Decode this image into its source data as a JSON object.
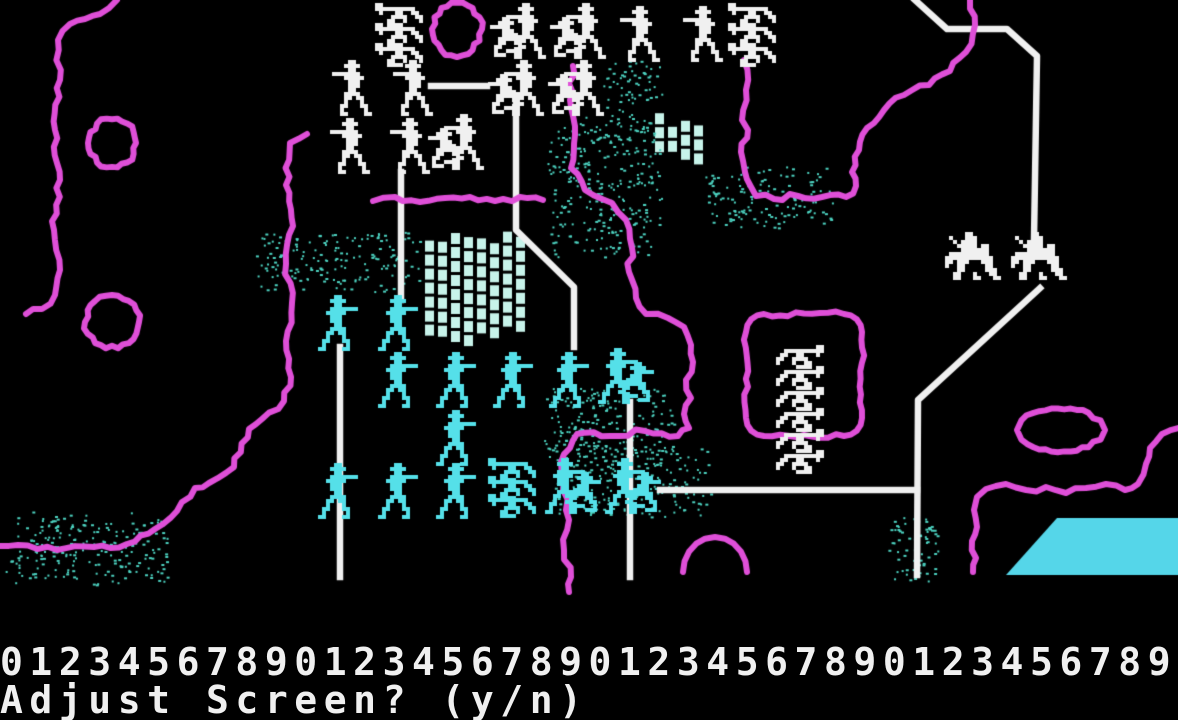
{
  "screen": {
    "width": 1178,
    "height": 720
  },
  "colors": {
    "background": "#000000",
    "white": "#f0f0f0",
    "cyan_unit": "#55e0e9",
    "forest_teal": "#4cd2c0",
    "brick": "#c7f3ea",
    "lake": "#55d6e9",
    "magenta": "#df4fd8",
    "road": "#f0f0f0",
    "text": "#f0f0f0"
  },
  "status": {
    "ruler": "0123456789012345678901234567890123456789",
    "prompt": "Adjust Screen? (y/n)"
  },
  "map": {
    "units": [
      {
        "kind": "cannon-unit",
        "color": "white",
        "mirror": false,
        "positions": [
          [
            375,
            3
          ],
          [
            375,
            23
          ],
          [
            375,
            43
          ],
          [
            728,
            3
          ],
          [
            728,
            23
          ],
          [
            728,
            43
          ]
        ]
      },
      {
        "kind": "infantry-pair-unit",
        "color": "white",
        "mirror": false,
        "positions": [
          [
            490,
            3
          ],
          [
            550,
            3
          ],
          [
            488,
            60
          ],
          [
            548,
            60
          ],
          [
            428,
            114
          ]
        ]
      },
      {
        "kind": "infantry-unit",
        "color": "white",
        "mirror": false,
        "positions": [
          [
            620,
            6
          ],
          [
            683,
            6
          ],
          [
            332,
            60
          ],
          [
            393,
            60
          ],
          [
            330,
            118
          ],
          [
            390,
            118
          ]
        ]
      },
      {
        "kind": "cannon-unit",
        "color": "white",
        "mirror": true,
        "positions": [
          [
            772,
            345
          ],
          [
            772,
            366
          ],
          [
            772,
            387
          ],
          [
            772,
            408
          ],
          [
            772,
            429
          ],
          [
            772,
            450
          ]
        ]
      },
      {
        "kind": "cavalry-unit",
        "color": "white",
        "mirror": false,
        "positions": [
          [
            941,
            232
          ],
          [
            1007,
            232
          ]
        ]
      },
      {
        "kind": "infantry-unit",
        "color": "cyan",
        "mirror": true,
        "positions": [
          [
            318,
            295
          ],
          [
            378,
            295
          ],
          [
            378,
            352
          ],
          [
            436,
            352
          ],
          [
            493,
            352
          ],
          [
            549,
            352
          ],
          [
            436,
            410
          ],
          [
            318,
            463
          ],
          [
            378,
            463
          ],
          [
            436,
            463
          ]
        ]
      },
      {
        "kind": "infantry-pair-unit",
        "color": "cyan",
        "mirror": true,
        "positions": [
          [
            598,
            348
          ],
          [
            545,
            458
          ],
          [
            605,
            458
          ]
        ]
      },
      {
        "kind": "cannon-unit",
        "color": "cyan",
        "mirror": false,
        "positions": [
          [
            488,
            458
          ],
          [
            488,
            476
          ],
          [
            488,
            494
          ]
        ]
      }
    ],
    "rivers": [
      {
        "name": "west-creek",
        "points": [
          [
            117,
            0
          ],
          [
            100,
            14
          ],
          [
            70,
            24
          ],
          [
            58,
            40
          ],
          [
            60,
            80
          ],
          [
            55,
            130
          ],
          [
            60,
            180
          ],
          [
            54,
            230
          ],
          [
            60,
            270
          ],
          [
            55,
            295
          ],
          [
            42,
            309
          ],
          [
            26,
            314
          ]
        ]
      },
      {
        "name": "southwest-river",
        "points": [
          [
            307,
            134
          ],
          [
            290,
            143
          ],
          [
            286,
            185
          ],
          [
            293,
            226
          ],
          [
            286,
            264
          ],
          [
            292,
            303
          ],
          [
            286,
            341
          ],
          [
            291,
            377
          ],
          [
            284,
            401
          ],
          [
            262,
            419
          ],
          [
            249,
            429
          ],
          [
            234,
            467
          ],
          [
            209,
            483
          ],
          [
            195,
            488
          ],
          [
            177,
            511
          ],
          [
            155,
            529
          ],
          [
            127,
            544
          ],
          [
            94,
            547
          ],
          [
            57,
            550
          ],
          [
            18,
            545
          ],
          [
            0,
            546
          ]
        ]
      },
      {
        "name": "central-river",
        "points": [
          [
            573,
            66
          ],
          [
            570,
            100
          ],
          [
            575,
            135
          ],
          [
            571,
            168
          ],
          [
            585,
            190
          ],
          [
            612,
            203
          ],
          [
            626,
            220
          ],
          [
            632,
            248
          ],
          [
            629,
            272
          ],
          [
            636,
            298
          ],
          [
            646,
            314
          ],
          [
            668,
            318
          ],
          [
            684,
            327
          ],
          [
            691,
            345
          ],
          [
            693,
            362
          ],
          [
            686,
            380
          ],
          [
            691,
            398
          ],
          [
            684,
            414
          ],
          [
            689,
            428
          ],
          [
            678,
            436
          ],
          [
            645,
            431
          ],
          [
            610,
            436
          ],
          [
            577,
            434
          ],
          [
            570,
            448
          ],
          [
            561,
            462
          ],
          [
            563,
            490
          ],
          [
            569,
            520
          ],
          [
            564,
            550
          ],
          [
            571,
            577
          ],
          [
            569,
            592
          ]
        ]
      },
      {
        "name": "north-river",
        "points": [
          [
            970,
            0
          ],
          [
            975,
            25
          ],
          [
            966,
            52
          ],
          [
            950,
            71
          ],
          [
            929,
            85
          ],
          [
            904,
            95
          ],
          [
            884,
            110
          ],
          [
            867,
            128
          ],
          [
            859,
            150
          ],
          [
            852,
            172
          ],
          [
            856,
            186
          ],
          [
            846,
            197
          ],
          [
            822,
            197
          ],
          [
            798,
            196
          ],
          [
            774,
            199
          ],
          [
            756,
            196
          ],
          [
            750,
            185
          ],
          [
            745,
            172
          ],
          [
            741,
            152
          ],
          [
            748,
            130
          ],
          [
            742,
            120
          ],
          [
            746,
            90
          ],
          [
            744,
            60
          ]
        ]
      },
      {
        "name": "southeast-river",
        "points": [
          [
            1178,
            428
          ],
          [
            1162,
            434
          ],
          [
            1150,
            448
          ],
          [
            1146,
            464
          ],
          [
            1138,
            484
          ],
          [
            1125,
            490
          ],
          [
            1106,
            484
          ],
          [
            1086,
            488
          ],
          [
            1066,
            493
          ],
          [
            1046,
            487
          ],
          [
            1026,
            490
          ],
          [
            1006,
            484
          ],
          [
            986,
            489
          ],
          [
            977,
            497
          ],
          [
            974,
            510
          ],
          [
            977,
            527
          ],
          [
            972,
            541
          ],
          [
            976,
            558
          ],
          [
            973,
            572
          ]
        ]
      },
      {
        "name": "small-branch",
        "points": [
          [
            373,
            201
          ],
          [
            395,
            197
          ],
          [
            420,
            202
          ],
          [
            445,
            198
          ],
          [
            470,
            197
          ],
          [
            495,
            201
          ],
          [
            520,
            197
          ],
          [
            543,
            200
          ]
        ]
      }
    ],
    "roads": [
      {
        "name": "north-road",
        "points": [
          [
            915,
            0
          ],
          [
            947,
            29
          ],
          [
            1007,
            29
          ],
          [
            1037,
            56
          ],
          [
            1034,
            240
          ]
        ]
      },
      {
        "name": "east-road",
        "points": [
          [
            1040,
            288
          ],
          [
            918,
            400
          ],
          [
            917,
            575
          ]
        ]
      },
      {
        "name": "south-road",
        "points": [
          [
            660,
            490
          ],
          [
            917,
            490
          ]
        ]
      },
      {
        "name": "center-road",
        "points": [
          [
            630,
            402
          ],
          [
            630,
            577
          ]
        ]
      },
      {
        "name": "west-road",
        "points": [
          [
            340,
            347
          ],
          [
            340,
            577
          ]
        ]
      },
      {
        "name": "mid-road",
        "points": [
          [
            401,
            172
          ],
          [
            401,
            300
          ]
        ]
      },
      {
        "name": "pike-road",
        "points": [
          [
            516,
            105
          ],
          [
            516,
            230
          ],
          [
            574,
            287
          ],
          [
            574,
            347
          ]
        ]
      },
      {
        "name": "road-stub",
        "points": [
          [
            431,
            86
          ],
          [
            487,
            86
          ]
        ]
      }
    ],
    "ponds": [
      {
        "name": "pond",
        "cx": 112,
        "cy": 143,
        "rx": 24,
        "ry": 25
      },
      {
        "name": "pond",
        "cx": 112,
        "cy": 322,
        "rx": 27,
        "ry": 27
      },
      {
        "name": "pond",
        "cx": 457,
        "cy": 29,
        "rx": 25,
        "ry": 27
      },
      {
        "name": "pond",
        "cx": 1061,
        "cy": 430,
        "rx": 44,
        "ry": 22
      }
    ],
    "enclosure": {
      "name": "field-boundary",
      "x": 746,
      "y": 314,
      "w": 116,
      "h": 122,
      "r": 18
    },
    "arc": {
      "name": "hill-arc",
      "cx": 715,
      "cy": 572,
      "rx": 32,
      "ry": 35
    },
    "forests": [
      [
        600,
        52,
        62,
        66
      ],
      [
        543,
        112,
        120,
        146
      ],
      [
        700,
        163,
        136,
        66
      ],
      [
        253,
        228,
        172,
        64
      ],
      [
        540,
        385,
        136,
        86
      ],
      [
        548,
        440,
        166,
        80
      ],
      [
        0,
        510,
        170,
        76
      ],
      [
        884,
        514,
        62,
        72
      ]
    ],
    "brick_walls": [
      [
        425,
        228,
        112,
        118
      ],
      [
        655,
        112,
        56,
        60
      ]
    ],
    "lake": {
      "points": [
        [
          1057,
          518
        ],
        [
          1178,
          518
        ],
        [
          1178,
          575
        ],
        [
          1006,
          575
        ]
      ]
    }
  }
}
